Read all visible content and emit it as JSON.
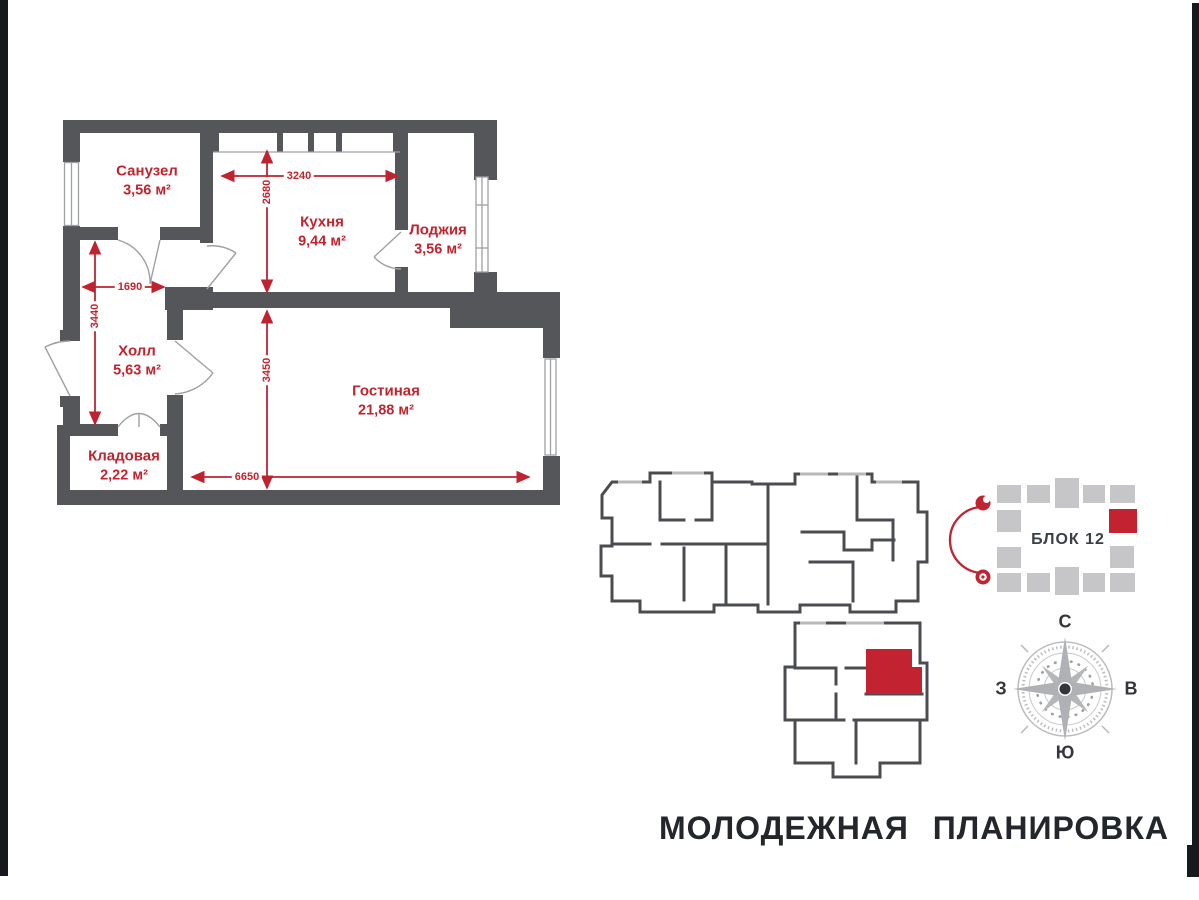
{
  "title": "МОЛОДЕЖНАЯ ПЛАНИРОВКА",
  "floorplan": {
    "rooms": [
      {
        "name": "Санузел",
        "area": "3,56 м²"
      },
      {
        "name": "Кухня",
        "area": "9,44 м²"
      },
      {
        "name": "Лоджия",
        "area": "3,56 м²"
      },
      {
        "name": "Холл",
        "area": "5,63 м²"
      },
      {
        "name": "Гостиная",
        "area": "21,88 м²"
      },
      {
        "name": "Кладовая",
        "area": "2,22 м²"
      }
    ],
    "dimensions_mm": [
      "3240",
      "2680",
      "1690",
      "3440",
      "3450",
      "6650"
    ]
  },
  "block": {
    "label": "БЛОК 12"
  },
  "compass": {
    "north": "С",
    "south": "Ю",
    "east": "В",
    "west": "З"
  },
  "colors": {
    "accent_red": "#c0242f",
    "wall_gray": "#55565a",
    "building_outline": "#4b4c50",
    "block_square_gray": "#c6c6c8",
    "compass_gray": "#b7b8ba",
    "title_dark": "#23262b"
  }
}
